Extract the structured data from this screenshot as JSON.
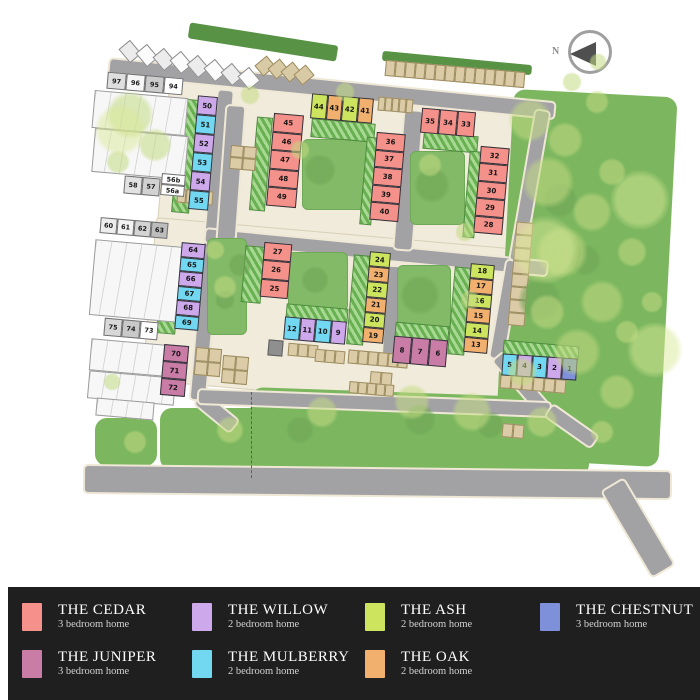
{
  "page": {
    "background": "#ffffff"
  },
  "north_arrow": {
    "label": "N"
  },
  "house_types": {
    "cedar": {
      "label": "THE CEDAR",
      "sub": "3 bedroom home",
      "color": "#F4918A"
    },
    "willow": {
      "label": "THE WILLOW",
      "sub": "2 bedroom home",
      "color": "#CDA9EC"
    },
    "ash": {
      "label": "THE ASH",
      "sub": "2 bedroom home",
      "color": "#CDE55E"
    },
    "chestnut": {
      "label": "THE CHESTNUT",
      "sub": "3 bedroom home",
      "color": "#7E90DA"
    },
    "juniper": {
      "label": "THE JUNIPER",
      "sub": "3 bedroom home",
      "color": "#C87CA6"
    },
    "mulberry": {
      "label": "THE MULBERRY",
      "sub": "2 bedroom home",
      "color": "#72D7F0"
    },
    "oak": {
      "label": "THE OAK",
      "sub": "2 bedroom home",
      "color": "#F2B06E"
    }
  },
  "legend": {
    "order": [
      "cedar",
      "willow",
      "ash",
      "chestnut",
      "juniper",
      "mulberry",
      "oak"
    ]
  },
  "site_plan": {
    "plot_blocks": [
      {
        "id": "b50-55",
        "x": 193,
        "y": 96,
        "dir": "v",
        "uw": 20,
        "uh": 19,
        "rot": 5,
        "units": [
          {
            "n": "50",
            "t": "willow"
          },
          {
            "n": "51",
            "t": "mulberry"
          },
          {
            "n": "52",
            "t": "willow"
          },
          {
            "n": "53",
            "t": "mulberry"
          },
          {
            "n": "54",
            "t": "willow"
          },
          {
            "n": "55",
            "t": "mulberry"
          }
        ]
      },
      {
        "id": "b45-49",
        "x": 270,
        "y": 114,
        "dir": "v",
        "uw": 30,
        "uh": 18.5,
        "rot": 5,
        "units": [
          {
            "n": "45",
            "t": "cedar"
          },
          {
            "n": "46",
            "t": "cedar"
          },
          {
            "n": "47",
            "t": "cedar"
          },
          {
            "n": "48",
            "t": "cedar"
          },
          {
            "n": "49",
            "t": "cedar"
          }
        ]
      },
      {
        "id": "b44-41",
        "x": 311,
        "y": 96,
        "dir": "h",
        "uw": 15.5,
        "uh": 25,
        "rot": 5,
        "units": [
          {
            "n": "44",
            "t": "ash"
          },
          {
            "n": "43",
            "t": "oak"
          },
          {
            "n": "42",
            "t": "ash"
          },
          {
            "n": "41",
            "t": "oak"
          }
        ]
      },
      {
        "id": "b36-40",
        "x": 373,
        "y": 133,
        "dir": "v",
        "uw": 29,
        "uh": 17.6,
        "rot": 5,
        "units": [
          {
            "n": "36",
            "t": "cedar"
          },
          {
            "n": "37",
            "t": "cedar"
          },
          {
            "n": "38",
            "t": "cedar"
          },
          {
            "n": "39",
            "t": "cedar"
          },
          {
            "n": "40",
            "t": "cedar"
          }
        ]
      },
      {
        "id": "b35-33",
        "x": 421,
        "y": 110,
        "dir": "h",
        "uw": 18,
        "uh": 25,
        "rot": 5,
        "units": [
          {
            "n": "35",
            "t": "cedar"
          },
          {
            "n": "34",
            "t": "cedar"
          },
          {
            "n": "33",
            "t": "cedar"
          }
        ]
      },
      {
        "id": "b32-28",
        "x": 477,
        "y": 147,
        "dir": "v",
        "uw": 29,
        "uh": 17.4,
        "rot": 5,
        "units": [
          {
            "n": "32",
            "t": "cedar"
          },
          {
            "n": "31",
            "t": "cedar"
          },
          {
            "n": "30",
            "t": "cedar"
          },
          {
            "n": "29",
            "t": "cedar"
          },
          {
            "n": "28",
            "t": "cedar"
          }
        ]
      },
      {
        "id": "b64-69",
        "x": 178,
        "y": 243,
        "dir": "v",
        "uw": 24,
        "uh": 14.5,
        "rot": 5,
        "units": [
          {
            "n": "64",
            "t": "willow"
          },
          {
            "n": "65",
            "t": "mulberry"
          },
          {
            "n": "66",
            "t": "willow"
          },
          {
            "n": "67",
            "t": "mulberry"
          },
          {
            "n": "68",
            "t": "willow"
          },
          {
            "n": "69",
            "t": "mulberry"
          }
        ]
      },
      {
        "id": "b27-25",
        "x": 262,
        "y": 243,
        "dir": "v",
        "uw": 28,
        "uh": 18.3,
        "rot": 5,
        "units": [
          {
            "n": "27",
            "t": "cedar"
          },
          {
            "n": "26",
            "t": "cedar"
          },
          {
            "n": "25",
            "t": "cedar"
          }
        ]
      },
      {
        "id": "b24-19",
        "x": 366,
        "y": 252,
        "dir": "v",
        "uw": 21,
        "uh": 15.2,
        "rot": 5,
        "units": [
          {
            "n": "24",
            "t": "ash"
          },
          {
            "n": "23",
            "t": "oak"
          },
          {
            "n": "22",
            "t": "ash"
          },
          {
            "n": "21",
            "t": "oak"
          },
          {
            "n": "20",
            "t": "ash"
          },
          {
            "n": "19",
            "t": "oak"
          }
        ]
      },
      {
        "id": "b12-9",
        "x": 284,
        "y": 319,
        "dir": "h",
        "uw": 15.5,
        "uh": 23,
        "rot": 5,
        "units": [
          {
            "n": "12",
            "t": "mulberry"
          },
          {
            "n": "11",
            "t": "willow"
          },
          {
            "n": "10",
            "t": "mulberry"
          },
          {
            "n": "9",
            "t": "willow"
          }
        ]
      },
      {
        "id": "b8-6",
        "x": 393,
        "y": 338,
        "dir": "h",
        "uw": 18,
        "uh": 27,
        "rot": 5,
        "units": [
          {
            "n": "8",
            "t": "juniper"
          },
          {
            "n": "7",
            "t": "juniper"
          },
          {
            "n": "6",
            "t": "juniper"
          }
        ]
      },
      {
        "id": "b18-13",
        "x": 467,
        "y": 264,
        "dir": "v",
        "uw": 24,
        "uh": 14.8,
        "rot": 5,
        "units": [
          {
            "n": "18",
            "t": "ash"
          },
          {
            "n": "17",
            "t": "oak"
          },
          {
            "n": "16",
            "t": "ash"
          },
          {
            "n": "15",
            "t": "oak"
          },
          {
            "n": "14",
            "t": "ash"
          },
          {
            "n": "13",
            "t": "oak"
          }
        ]
      },
      {
        "id": "b5-1",
        "x": 502,
        "y": 356,
        "dir": "h",
        "uw": 15,
        "uh": 22,
        "rot": 4,
        "units": [
          {
            "n": "5",
            "t": "mulberry"
          },
          {
            "n": "4",
            "t": "willow"
          },
          {
            "n": "3",
            "t": "mulberry"
          },
          {
            "n": "2",
            "t": "willow"
          },
          {
            "n": "1",
            "t": "chestnut"
          }
        ]
      },
      {
        "id": "b70-72",
        "x": 162,
        "y": 345,
        "dir": "v",
        "uw": 25,
        "uh": 17,
        "rot": 5,
        "units": [
          {
            "n": "70",
            "t": "juniper"
          },
          {
            "n": "71",
            "t": "juniper"
          },
          {
            "n": "72",
            "t": "juniper"
          }
        ]
      }
    ],
    "grey_blocks": [
      {
        "id": "g97-94",
        "x": 107,
        "y": 75,
        "dir": "h",
        "uw": 19,
        "uh": 17,
        "rot": 5,
        "units": [
          {
            "n": "97",
            "s": "#dfdfdf"
          },
          {
            "n": "96",
            "s": "#f6f6f6"
          },
          {
            "n": "95",
            "s": "#cccccc"
          },
          {
            "n": "94",
            "s": "#ffffff"
          }
        ]
      },
      {
        "id": "g58-57",
        "x": 124,
        "y": 177,
        "dir": "h",
        "uw": 18,
        "uh": 18,
        "rot": 5,
        "units": [
          {
            "n": "58",
            "s": "#e2e2e2"
          },
          {
            "n": "57",
            "s": "#d2d2d2"
          }
        ]
      },
      {
        "id": "g56",
        "x": 161,
        "y": 174,
        "dir": "v",
        "uw": 24,
        "uh": 11,
        "rot": 5,
        "units": [
          {
            "n": "56b",
            "s": "#ffffff"
          },
          {
            "n": "56a",
            "s": "#ffffff"
          }
        ]
      },
      {
        "id": "g60-63",
        "x": 100,
        "y": 220,
        "dir": "h",
        "uw": 17,
        "uh": 16,
        "rot": 5,
        "units": [
          {
            "n": "60",
            "s": "#ededed"
          },
          {
            "n": "61",
            "s": "#f4f4f4"
          },
          {
            "n": "62",
            "s": "#d4d4d4"
          },
          {
            "n": "63",
            "s": "#bdbdbd"
          }
        ]
      },
      {
        "id": "g75-73",
        "x": 104,
        "y": 320,
        "dir": "h",
        "uw": 18,
        "uh": 18,
        "rot": 5,
        "units": [
          {
            "n": "75",
            "s": "#d8d8d8"
          },
          {
            "n": "74",
            "s": "#c9c9c9"
          },
          {
            "n": "73",
            "s": "#ffffff"
          }
        ]
      }
    ]
  }
}
